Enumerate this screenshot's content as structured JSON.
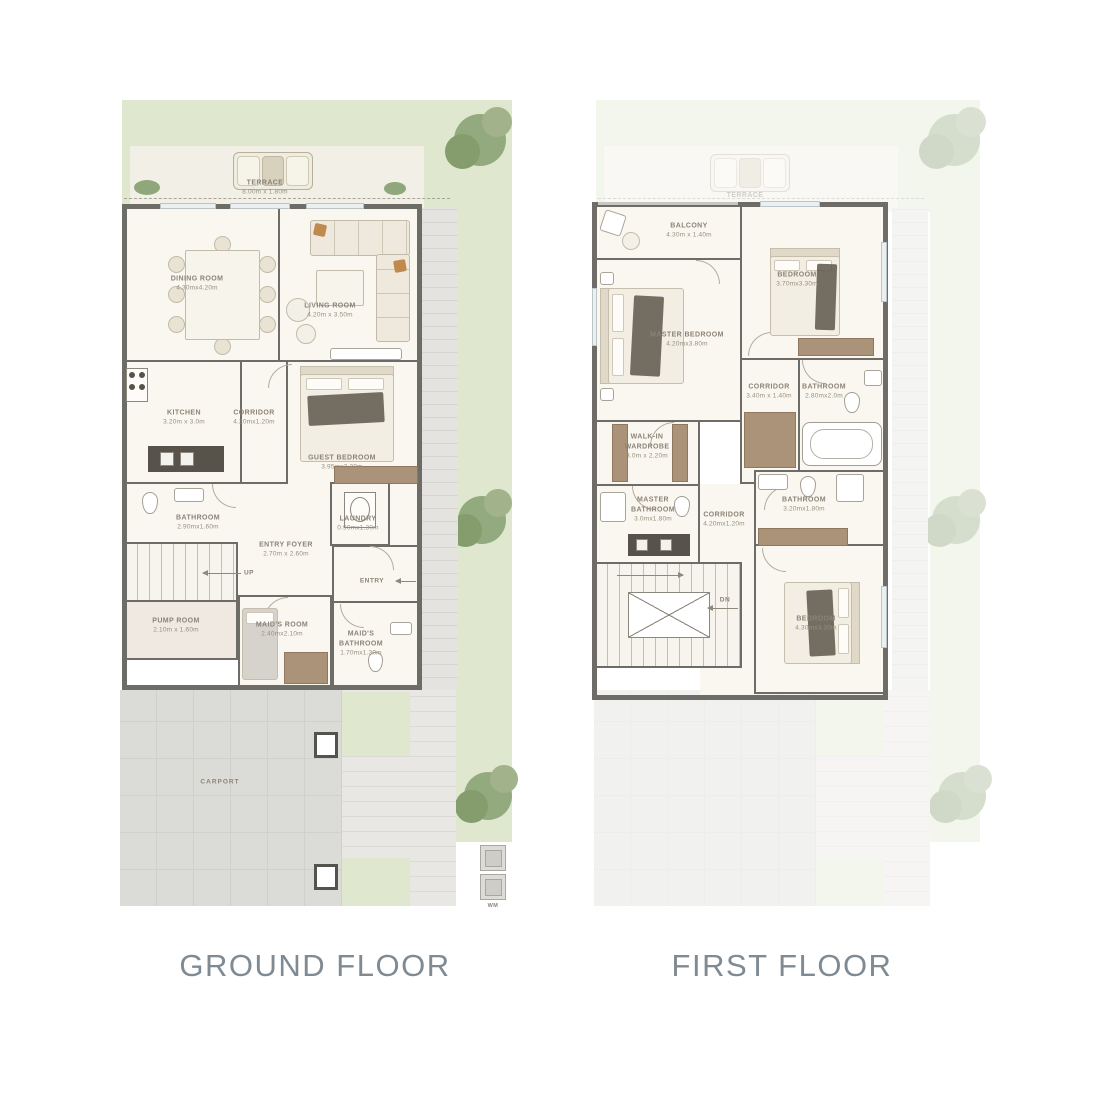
{
  "titles": [
    {
      "label": "GROUND FLOOR"
    },
    {
      "label": "FIRST FLOOR"
    }
  ],
  "ground_floor": {
    "terrace": {
      "name": "TERRACE",
      "dims": "8.00m x 1.80m"
    },
    "rooms": [
      {
        "id": "dining-room",
        "name": "DINING ROOM",
        "dims": "4.30mx4.20m"
      },
      {
        "id": "living-room",
        "name": "LIVING ROOM",
        "dims": "4.20m x 3.50m"
      },
      {
        "id": "kitchen",
        "name": "KITCHEN",
        "dims": "3.20m x 3.0m"
      },
      {
        "id": "corridor",
        "name": "CORRIDOR",
        "dims": "4.20mx1.20m"
      },
      {
        "id": "guest-bedroom",
        "name": "GUEST BEDROOM",
        "dims": "3.95mx3.30m"
      },
      {
        "id": "bathroom",
        "name": "BATHROOM",
        "dims": "2.90mx1.60m"
      },
      {
        "id": "laundry",
        "name": "LAUNDRY",
        "dims": "0.90mx1.30m"
      },
      {
        "id": "entry-foyer",
        "name": "ENTRY FOYER",
        "dims": "2.70m x 2.60m"
      },
      {
        "id": "pump-room",
        "name": "PUMP ROOM",
        "dims": "2.10m x 1.60m"
      },
      {
        "id": "maids-room",
        "name": "MAID'S ROOM",
        "dims": "2.40mx2.10m"
      },
      {
        "id": "maids-bathroom",
        "name": "MAID'S BATHROOM",
        "dims": "1.70mx1.30m"
      }
    ],
    "labels": {
      "entry": "ENTRY",
      "up": "UP",
      "carport": "CARPORT",
      "wm": "WM"
    }
  },
  "first_floor": {
    "rooms": [
      {
        "id": "balcony",
        "name": "BALCONY",
        "dims": "4.30m x 1.40m"
      },
      {
        "id": "master-bedroom",
        "name": "MASTER BEDROOM",
        "dims": "4.20mx3.80m"
      },
      {
        "id": "bedroom-1",
        "name": "BEDROOM",
        "dims": "3.70mx3.30m"
      },
      {
        "id": "bathroom-1",
        "name": "BATHROOM",
        "dims": "2.80mx2.0m"
      },
      {
        "id": "corridor-1",
        "name": "CORRIDOR",
        "dims": "3.40m x 1.40m"
      },
      {
        "id": "walkin-wardrobe",
        "name": "WALK-IN WARDROBE",
        "dims": "3.0m x 2.20m"
      },
      {
        "id": "master-bathroom",
        "name": "MASTER BATHROOM",
        "dims": "3.0mx1.80m"
      },
      {
        "id": "corridor-2",
        "name": "CORRIDOR",
        "dims": "4.20mx1.20m"
      },
      {
        "id": "bathroom-2",
        "name": "BATHROOM",
        "dims": "3.20mx1.80m"
      },
      {
        "id": "bedroom-2",
        "name": "BEDROOM",
        "dims": "4.30mx3.30m"
      }
    ],
    "labels": {
      "dn": "DN"
    }
  },
  "colors": {
    "wall": "#6e6c66",
    "floor": "#faf7f0",
    "garden": "#dfe8cf",
    "paving": "#e5e4e0",
    "carport": "#dbdbd7",
    "wardrobe": "#ab9379",
    "room_label": "#8c8376",
    "title_text": "#7f8a93",
    "accent_pillow": "#c08a4f"
  }
}
